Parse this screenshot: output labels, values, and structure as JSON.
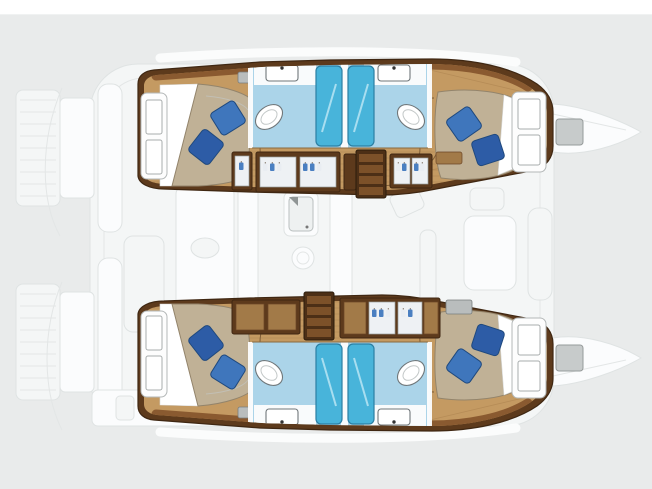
{
  "diagram": {
    "type": "catamaran-floorplan",
    "view": "top-down",
    "description": "Top-down interior layout plan of a four-cabin sailing catamaran: two wood-floored hulls each with an aft double cabin, twin back-to-back bathrooms with shower stalls, a forward double cabin, wardrobes with hanging clothes and a stairway to the saloon; the central saloon, galley, stern platforms and bows are shown faded",
    "hulls": [
      {
        "name": "port-hull-top",
        "cabins": [
          "aft-double-cabin",
          "forward-double-cabin"
        ],
        "bathrooms": 2,
        "features": [
          "double-berth-with-two-blue-pillows",
          "white-bed-sheet",
          "hull-window-panels",
          "twin-shower-stalls",
          "toilet",
          "vanity-sink",
          "wardrobes-with-hanging-clothes",
          "stairway-to-saloon",
          "air-vent"
        ]
      },
      {
        "name": "starboard-hull-bottom",
        "cabins": [
          "aft-double-cabin",
          "forward-double-cabin"
        ],
        "bathrooms": 2,
        "features": [
          "double-berth-with-two-blue-pillows",
          "white-bed-sheet",
          "hull-window-panels",
          "twin-shower-stalls",
          "toilet",
          "vanity-sink",
          "wardrobes-with-hanging-clothes",
          "stairway-to-saloon",
          "air-vent"
        ]
      }
    ],
    "saloon": {
      "render": "faded",
      "features": [
        "galley-counter",
        "galley-sink",
        "stove-burner",
        "refrigerator-column",
        "dining-table",
        "seating",
        "companionway"
      ]
    },
    "exterior": {
      "render": "faded",
      "features": [
        "stern-swim-platforms",
        "cockpit",
        "deck-outline",
        "bow-deck-hatches",
        "bow-tips"
      ]
    }
  },
  "palette": {
    "bg": "#e9ebeb",
    "topStrip": "#ffffff",
    "woodDark": "#5d3a1c",
    "woodOutline": "#3f2712",
    "woodMid": "#8a5a30",
    "floor": "#c49a62",
    "plank": "#a87f4c",
    "mattress": "#c0b196",
    "mattressEdge": "#93846b",
    "sheet": "#ffffff",
    "pillow": "#3f76bc",
    "pillowDark": "#2d5ca6",
    "pillowStroke": "#1f497e",
    "bathFloor": "#abd4e9",
    "bathEdge": "#7fb0ca",
    "shower": "#48b4da",
    "showerEdge": "#2b7fa3",
    "fixture": "#ffffff",
    "fixtureStroke": "#70777a",
    "faintFill": "#f4f6f6",
    "faintStroke": "#dfe3e3",
    "hatch": "#c7cbcb",
    "hatchStroke": "#969b9b",
    "garment": "#4a7fc1",
    "stair": "#4c2f16",
    "stepFace": "#7c5129",
    "arc": "#7d5c36"
  }
}
